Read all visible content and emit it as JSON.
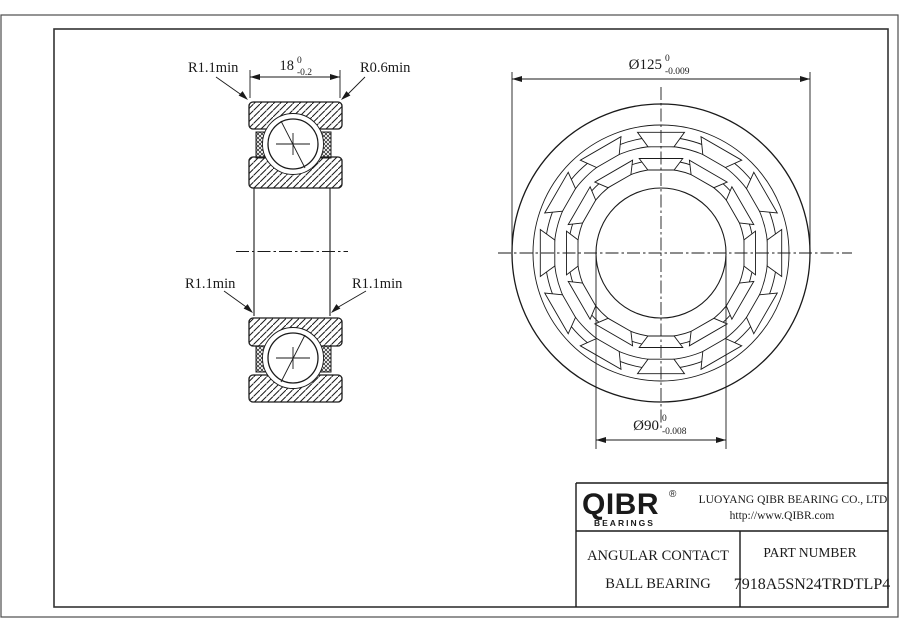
{
  "drawing": {
    "type": "bearing engineering drawing",
    "section_view": {
      "label_top_left": "R1.1min",
      "label_top_right": "R0.6min",
      "label_mid_left": "R1.1min",
      "label_mid_right": "R1.1min",
      "width_dim": {
        "value": "18",
        "upper_tol": "0",
        "lower_tol": "-0.2"
      }
    },
    "front_view": {
      "od_dim": {
        "value": "Ø125",
        "upper_tol": "0",
        "lower_tol": "-0.009"
      },
      "bore_dim": {
        "value": "Ø90",
        "upper_tol": "0",
        "lower_tol": "-0.008"
      }
    }
  },
  "title_block": {
    "logo": {
      "name": "QIBR",
      "registered": "®",
      "subtext": "BEARINGS"
    },
    "company": "LUOYANG QIBR BEARING CO., LTD",
    "website": "http://www.QIBR.com",
    "product_line1": "ANGULAR CONTACT",
    "product_line2": "BALL BEARING",
    "part_number_label": "PART NUMBER",
    "part_number": "7918A5SN24TRDTLP4"
  },
  "colors": {
    "line": "#1a1a1a",
    "frame": "#4d4d4d",
    "background": "#ffffff"
  }
}
